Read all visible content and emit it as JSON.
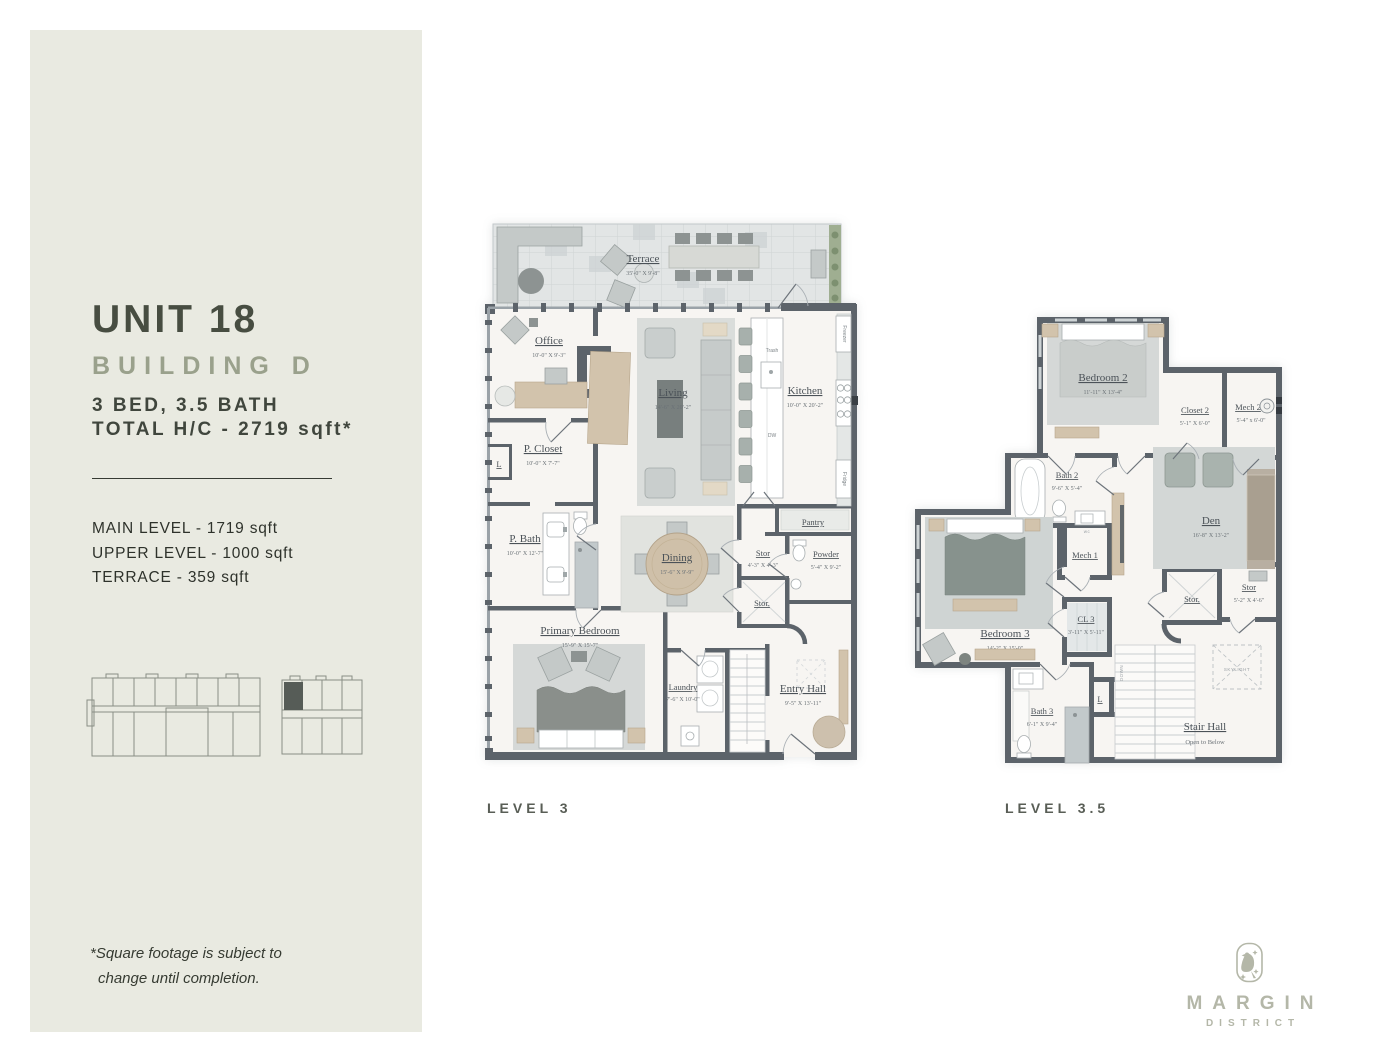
{
  "sidebar": {
    "unit_title": "UNIT 18",
    "building": "BUILDING D",
    "specs": {
      "beds_baths": "3 BED, 3.5 BATH",
      "total": "TOTAL H/C - 2719 sqft*"
    },
    "areas": [
      "MAIN LEVEL - 1719 sqft",
      "UPPER LEVEL - 1000 sqft",
      "TERRACE - 359 sqft"
    ],
    "footnote": {
      "line1": "*Square footage is subject to",
      "line2": "change until completion."
    }
  },
  "plans": {
    "level3": {
      "caption": "LEVEL 3",
      "rooms": {
        "terrace": {
          "name": "Terrace",
          "dims": "35'-0\" X 9'-8\""
        },
        "office": {
          "name": "Office",
          "dims": "10'-0\" X 9'-3\""
        },
        "p_closet": {
          "name": "P. Closet",
          "dims": "10'-0\" X 7'-7\""
        },
        "linen": {
          "name": "L"
        },
        "p_bath": {
          "name": "P. Bath",
          "dims": "10'-0\" X 12'-7\""
        },
        "living": {
          "name": "Living",
          "dims": "14'-6\" X 20'-2\""
        },
        "kitchen": {
          "name": "Kitchen",
          "dims": "10'-0\" X 20'-2\""
        },
        "dining": {
          "name": "Dining",
          "dims": "15'-6\" X 9'-9\""
        },
        "pantry": {
          "name": "Pantry"
        },
        "stor1": {
          "name": "Stor",
          "dims": "4'-3\" X 4'-3\""
        },
        "powder": {
          "name": "Powder",
          "dims": "5'-4\" X 9'-2\""
        },
        "stor2": {
          "name": "Stor."
        },
        "primary_bedroom": {
          "name": "Primary Bedroom",
          "dims": "15'-9\" X 15'-7\""
        },
        "laundry": {
          "name": "Laundry",
          "dims": "7'-6\" X 10'-0\""
        },
        "entry_hall": {
          "name": "Entry Hall",
          "dims": "9'-5\" X 13'-11\""
        }
      },
      "appliances": {
        "trash": "Trash",
        "dw": "DW",
        "freezer": "Freezer",
        "fridge": "Fridge"
      }
    },
    "level35": {
      "caption": "LEVEL 3.5",
      "rooms": {
        "bedroom2": {
          "name": "Bedroom 2",
          "dims": "11'-11\" X 13'-4\""
        },
        "closet2": {
          "name": "Closet 2",
          "dims": "5'-1\" X 6'-0\""
        },
        "mech2": {
          "name": "Mech 2",
          "dims": "5'-4\" x 6'-0\""
        },
        "bath2": {
          "name": "Bath 2",
          "dims": "9'-6\" X 5'-4\""
        },
        "den": {
          "name": "Den",
          "dims": "16'-8\" X 13'-2\""
        },
        "mech1": {
          "name": "Mech 1"
        },
        "bedroom3": {
          "name": "Bedroom 3",
          "dims": "14'-2\" X 15'-0\""
        },
        "cl3": {
          "name": "CL 3",
          "dims": "3'-11\" X 5'-11\""
        },
        "stor_a": {
          "name": "Stor."
        },
        "stor_b": {
          "name": "Stor",
          "dims": "5'-2\" X 4'-6\""
        },
        "bath3": {
          "name": "Bath 3",
          "dims": "6'-1\" X 9'-4\""
        },
        "linen": {
          "name": "L"
        },
        "stair_hall": {
          "name": "Stair Hall",
          "sub": "Open to Below"
        }
      },
      "annotations": {
        "down": "DOWN",
        "skylight": "SKYLIGHT",
        "wc": "wc"
      }
    }
  },
  "logo": {
    "brand": "MARGIN",
    "sub": "DISTRICT"
  },
  "colors": {
    "sidebar_bg": "#e9eae1",
    "wall": "#5c636a",
    "accent_dark": "#474d41",
    "accent_muted": "#9aa18c",
    "logo": "#b4b7a8"
  }
}
